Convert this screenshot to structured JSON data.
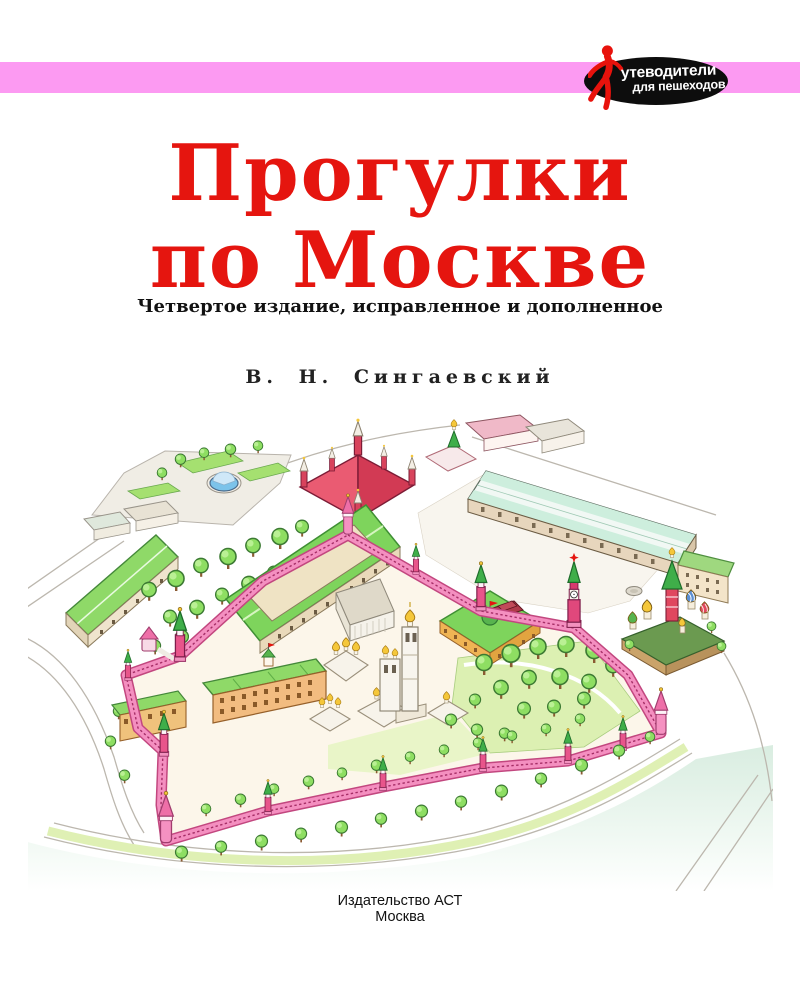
{
  "banner": {
    "stripe_color": "#fc9af2",
    "logo": {
      "bg_color": "#0d0d0d",
      "figure_color": "#e8120c",
      "line1": "утеводители",
      "line2": "для пешеходов"
    }
  },
  "title": {
    "line1": "Прогулки",
    "line2": "по Москве",
    "color": "#e5150f"
  },
  "edition_note": "Четвертое издание, исправленное и дополненное",
  "author": "В. Н. Сингаевский",
  "publisher": {
    "line1": "Издательство АСТ",
    "line2": "Москва"
  },
  "illustration": {
    "description": "Рисованная панорама Московского Кремля и Красной площади",
    "palette": {
      "kremlin_wall": "#f48fc0",
      "wall_edge": "#c2477f",
      "tower_red": "#e0487c",
      "tent_green": "#3fae49",
      "roof_green": "#8fd968",
      "tree_green": "#8ede62",
      "dome_gold": "#f5c73a",
      "museum_red": "#e0475f",
      "gum_roof_mint": "#cdeedd",
      "river": "#d7ecdf"
    }
  }
}
